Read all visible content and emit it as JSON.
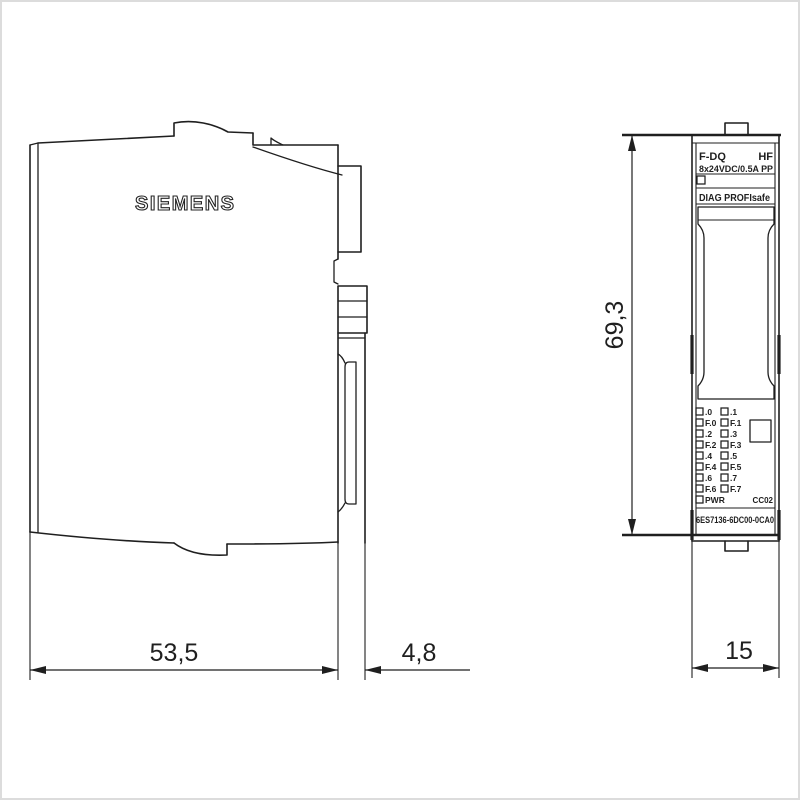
{
  "page": {
    "background": "#ffffff",
    "line_color": "#1f1f1f",
    "frame_color": "#dcdcdc",
    "description": "Dimension drawing, two views of a Siemens I/O module"
  },
  "side_view": {
    "brand": "SIEMENS",
    "dim_depth_label": "53,5",
    "dim_connector_label": "4,8"
  },
  "front_view": {
    "header": {
      "type_label": "F-DQ",
      "class_label": "HF",
      "rating_label": "8x24VDC/0.5A PP"
    },
    "diag_label": "DIAG PROFIsafe",
    "leds": {
      "rows": [
        {
          "left": ".0",
          "right": ".1"
        },
        {
          "left": "F.0",
          "right": "F.1"
        },
        {
          "left": ".2",
          "right": ".3"
        },
        {
          "left": "F.2",
          "right": "F.3"
        },
        {
          "left": ".4",
          "right": ".5"
        },
        {
          "left": "F.4",
          "right": "F.5"
        },
        {
          "left": ".6",
          "right": ".7"
        },
        {
          "left": "F.6",
          "right": "F.7"
        },
        {
          "left": "PWR",
          "right": ""
        }
      ]
    },
    "version_label": "CC02",
    "order_number": "6ES7136-6DC00-0CA0",
    "dim_height_label": "69,3",
    "dim_width_label": "15"
  }
}
